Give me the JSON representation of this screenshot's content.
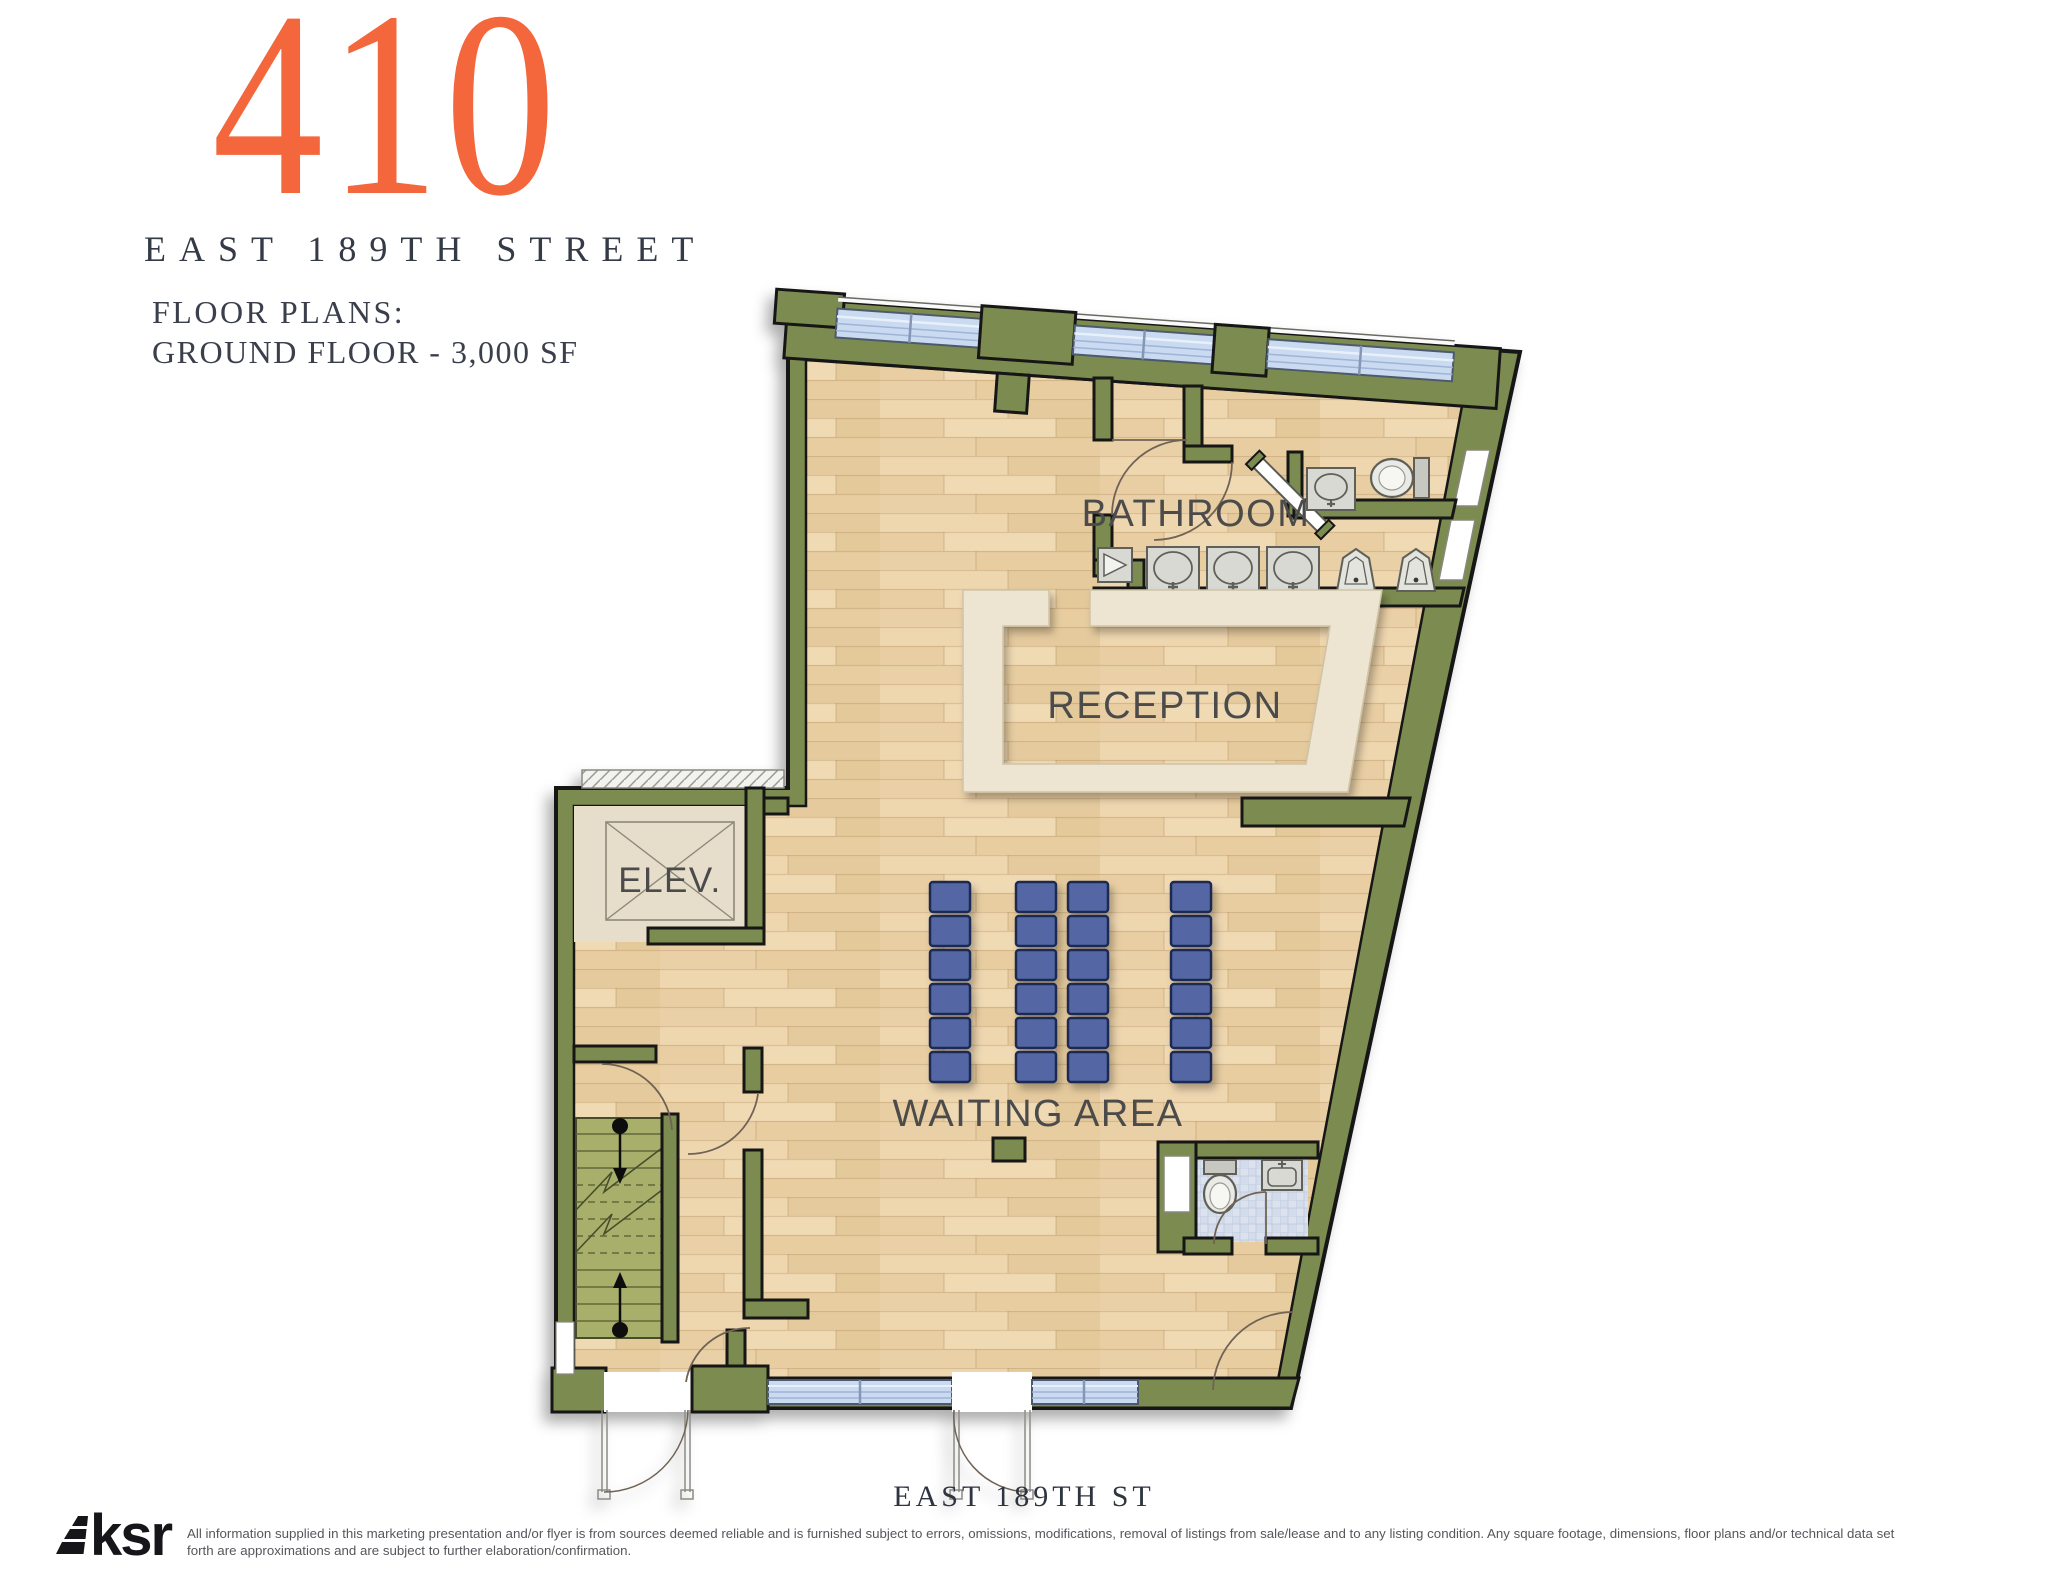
{
  "header": {
    "building_number": "410",
    "street_name": "EAST 189TH STREET",
    "floor_plans_label": "FLOOR PLANS:",
    "floor_detail": "GROUND FLOOR - 3,000 SF"
  },
  "plan": {
    "labels": {
      "bathroom": "BATHROOM",
      "reception": "RECEPTION",
      "elevator": "ELEV.",
      "waiting_area": "WAITING AREA",
      "street": "EAST 189TH ST"
    }
  },
  "footer": {
    "logo_text": "ksr",
    "disclaimer_line1": "All information supplied in this marketing presentation and/or flyer is from sources deemed reliable and is furnished subject to errors, omissions, modifications, removal of listings from sale/lease and to any listing condition. Any square footage, dimensions, floor plans and/or technical data set",
    "disclaimer_line2": "forth are approximations and are subject to further elaboration/confirmation."
  },
  "colors": {
    "accent_orange": "#F4663B",
    "wall_green": "#7C8B50",
    "wall_outline": "#161616",
    "floor_wood": "#EBD2A8",
    "window_blue": "#C9DAF1",
    "counter_cream": "#EDE5D2",
    "elevator_beige": "#E6DECB",
    "stair_olive": "#A8AF6B",
    "seat_blue": "#5566A4",
    "tile_blue": "#DCE3EF",
    "fixture_gray": "#D9D9D4",
    "text_dark": "#343A46",
    "label_gray": "#4B4B4B"
  }
}
